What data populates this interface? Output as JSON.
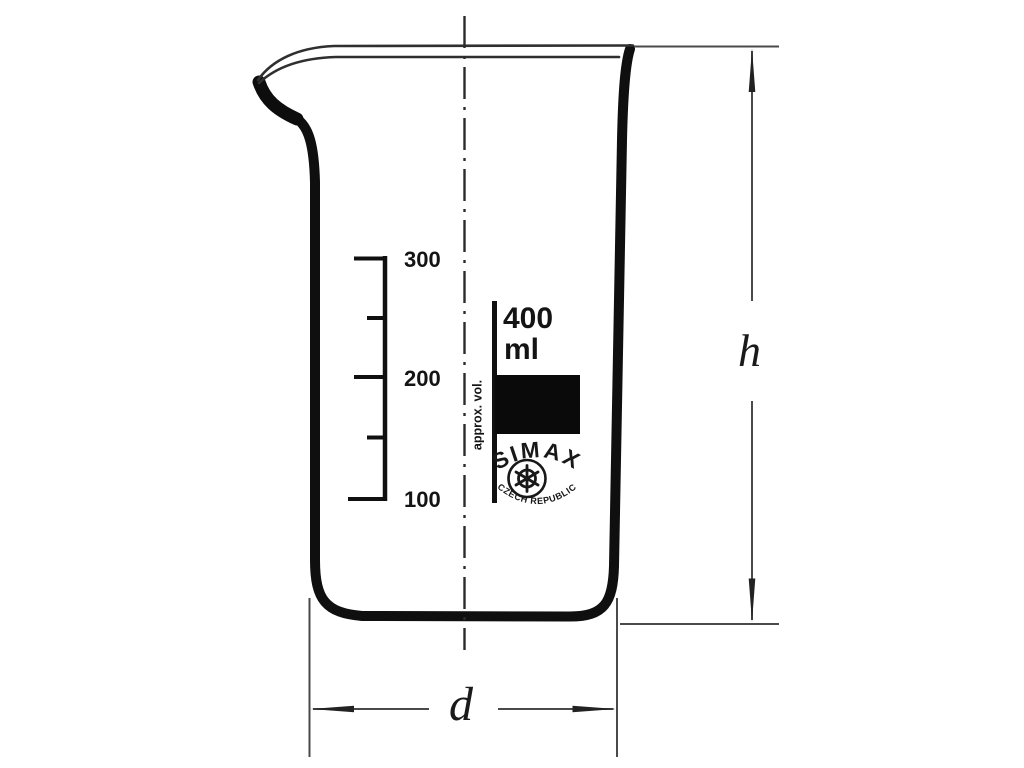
{
  "page": {
    "background": "#ffffff",
    "ink": "#141414",
    "thin_line": "#4a4a4a"
  },
  "beaker": {
    "graduations": [
      "300",
      "200",
      "100"
    ],
    "capacity": "400",
    "capacity_unit": "ml",
    "approx_volume_label": "approx. vol.",
    "logo": {
      "brand": "SIMAX",
      "country": "CZECH REPUBLIC"
    },
    "dimension_height": "h",
    "dimension_diameter": "d"
  }
}
